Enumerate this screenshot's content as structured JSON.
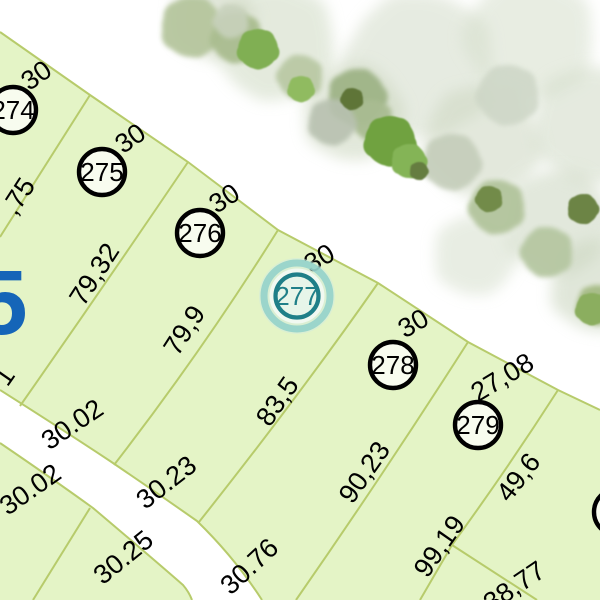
{
  "map": {
    "type": "cadastral-parcel-plan",
    "colors": {
      "background": "#ffffff",
      "parcel_fill": "#e4f4c6",
      "boundary_line": "#b7cb6b",
      "road_fill": "#ffffff",
      "plot_circle_stroke": "#000000",
      "plot_circle_fill": "#f8fcef",
      "label_text": "#000000",
      "block_number_blue": "#1565b8",
      "highlight_ring": "#1f7f88",
      "highlight_halo": "#8fd0c9",
      "highlight_fill": "#e7f5e9"
    },
    "plots": [
      {
        "number": "274",
        "x": 13,
        "y": 110,
        "selected": false,
        "partial": true
      },
      {
        "number": "275",
        "x": 102,
        "y": 172,
        "selected": false,
        "partial": false
      },
      {
        "number": "276",
        "x": 200,
        "y": 233,
        "selected": false,
        "partial": false
      },
      {
        "number": "277",
        "x": 297,
        "y": 296,
        "selected": true,
        "partial": false
      },
      {
        "number": "278",
        "x": 393,
        "y": 365,
        "selected": false,
        "partial": false
      },
      {
        "number": "279",
        "x": 478,
        "y": 425,
        "selected": false,
        "partial": false
      },
      {
        "number": "",
        "x": 617,
        "y": 512,
        "selected": false,
        "partial": true
      }
    ],
    "frontage_labels": [
      {
        "t": "30",
        "x": 36,
        "y": 75,
        "r": -35
      },
      {
        "t": "30",
        "x": 130,
        "y": 138,
        "r": -35
      },
      {
        "t": "30",
        "x": 224,
        "y": 198,
        "r": -33
      },
      {
        "t": "30",
        "x": 319,
        "y": 258,
        "r": -30
      },
      {
        "t": "30",
        "x": 413,
        "y": 323,
        "r": -30
      },
      {
        "t": "27,08",
        "x": 502,
        "y": 377,
        "r": -31
      }
    ],
    "side_labels": [
      {
        "t": ",75",
        "x": 18,
        "y": 196,
        "r": -57
      },
      {
        "t": "79,32",
        "x": 94,
        "y": 274,
        "r": -57
      },
      {
        "t": "79,9",
        "x": 184,
        "y": 330,
        "r": -57
      },
      {
        "t": "83,5",
        "x": 277,
        "y": 401,
        "r": -55
      },
      {
        "t": "90,23",
        "x": 364,
        "y": 472,
        "r": -55
      },
      {
        "t": "99,19",
        "x": 439,
        "y": 546,
        "r": -55
      },
      {
        "t": "49,6",
        "x": 518,
        "y": 477,
        "r": -52
      }
    ],
    "rear_labels": [
      {
        "t": "30.02",
        "x": 72,
        "y": 424,
        "r": -34
      },
      {
        "t": "30.23",
        "x": 166,
        "y": 482,
        "r": -38
      },
      {
        "t": "30.76",
        "x": 249,
        "y": 566,
        "r": -43
      },
      {
        "t": "38,77",
        "x": 514,
        "y": 586,
        "r": -34
      }
    ],
    "across_road_labels": [
      {
        "t": "30.02",
        "x": 30,
        "y": 489,
        "r": -35
      },
      {
        "t": "30.25",
        "x": 123,
        "y": 557,
        "r": -39
      }
    ],
    "partial_labels": [
      {
        "t": "1",
        "x": 4,
        "y": 376,
        "r": -55
      },
      {
        "t": "5",
        "x": 2,
        "y": 302,
        "r": 0,
        "s": 92,
        "c": "#1565b8",
        "w": "bold"
      }
    ],
    "trees": [
      {
        "x": 275,
        "y": 42,
        "rad": 58,
        "c": "#cfdac3",
        "o": 0.55,
        "b": 1
      },
      {
        "x": 420,
        "y": 65,
        "rad": 72,
        "c": "#d3dcc9",
        "o": 0.55,
        "b": 1
      },
      {
        "x": 530,
        "y": 38,
        "rad": 62,
        "c": "#d6dfcc",
        "o": 0.55,
        "b": 1
      },
      {
        "x": 592,
        "y": 125,
        "rad": 58,
        "c": "#d0dac6",
        "o": 0.55,
        "b": 1
      },
      {
        "x": 482,
        "y": 142,
        "rad": 56,
        "c": "#cdd7c1",
        "o": 0.55,
        "b": 1
      },
      {
        "x": 558,
        "y": 222,
        "rad": 52,
        "c": "#cbd6c0",
        "o": 0.55,
        "b": 1
      },
      {
        "x": 598,
        "y": 285,
        "rad": 46,
        "c": "#ccd7c1",
        "o": 0.6,
        "b": 1
      },
      {
        "x": 352,
        "y": 112,
        "rad": 48,
        "c": "#cbd6bd",
        "o": 0.55,
        "b": 1
      },
      {
        "x": 212,
        "y": 18,
        "rad": 40,
        "c": "#cdd6c0",
        "o": 0.6,
        "b": 1
      },
      {
        "x": 475,
        "y": 255,
        "rad": 40,
        "c": "#d2dcc8",
        "o": 0.5,
        "b": 1
      },
      {
        "x": 192,
        "y": 27,
        "rad": 30,
        "c": "#b6c69e",
        "o": 0.95,
        "b": 2
      },
      {
        "x": 237,
        "y": 38,
        "rad": 25,
        "c": "#aabd90",
        "o": 0.95,
        "b": 2
      },
      {
        "x": 300,
        "y": 77,
        "rad": 22,
        "c": "#bac9a5",
        "o": 0.95,
        "b": 2
      },
      {
        "x": 357,
        "y": 97,
        "rad": 28,
        "c": "#9fb487",
        "o": 0.95,
        "b": 2
      },
      {
        "x": 497,
        "y": 207,
        "rad": 27,
        "c": "#b2c49c",
        "o": 0.95,
        "b": 2
      },
      {
        "x": 547,
        "y": 252,
        "rad": 25,
        "c": "#b6c7a2",
        "o": 0.95,
        "b": 2
      },
      {
        "x": 372,
        "y": 120,
        "rad": 20,
        "c": "#a9bc92",
        "o": 0.95,
        "b": 2
      },
      {
        "x": 597,
        "y": 305,
        "rad": 20,
        "c": "#a6bb85",
        "o": 0.95,
        "b": 2
      },
      {
        "x": 332,
        "y": 122,
        "rad": 23,
        "c": "#b8c1b0",
        "o": 0.9,
        "b": 2
      },
      {
        "x": 452,
        "y": 162,
        "rad": 28,
        "c": "#c4cdba",
        "o": 0.9,
        "b": 2
      },
      {
        "x": 508,
        "y": 95,
        "rad": 30,
        "c": "#cdd6c6",
        "o": 0.85,
        "b": 2
      },
      {
        "x": 231,
        "y": 21,
        "rad": 17,
        "c": "#c8d1bc",
        "o": 0.9,
        "b": 2
      },
      {
        "x": 258,
        "y": 49,
        "rad": 20,
        "c": "#80af53",
        "o": 1,
        "b": 3
      },
      {
        "x": 390,
        "y": 141,
        "rad": 25,
        "c": "#6fa23f",
        "o": 1,
        "b": 3
      },
      {
        "x": 409,
        "y": 161,
        "rad": 17,
        "c": "#84b456",
        "o": 1,
        "b": 3
      },
      {
        "x": 301,
        "y": 89,
        "rad": 13,
        "c": "#90bb61",
        "o": 1,
        "b": 3
      },
      {
        "x": 352,
        "y": 99,
        "rad": 11,
        "c": "#5e7439",
        "o": 1,
        "b": 3
      },
      {
        "x": 583,
        "y": 209,
        "rad": 15,
        "c": "#6c8445",
        "o": 1,
        "b": 3
      },
      {
        "x": 489,
        "y": 199,
        "rad": 13,
        "c": "#728b49",
        "o": 1,
        "b": 3
      },
      {
        "x": 592,
        "y": 309,
        "rad": 16,
        "c": "#8bae5f",
        "o": 1,
        "b": 3
      },
      {
        "x": 419,
        "y": 171,
        "rad": 9,
        "c": "#657d3f",
        "o": 1,
        "b": 3
      }
    ],
    "geometry_note": "parcel row faces tree belt at top-right; curved road crosses lower-left; plot 277 highlighted"
  }
}
